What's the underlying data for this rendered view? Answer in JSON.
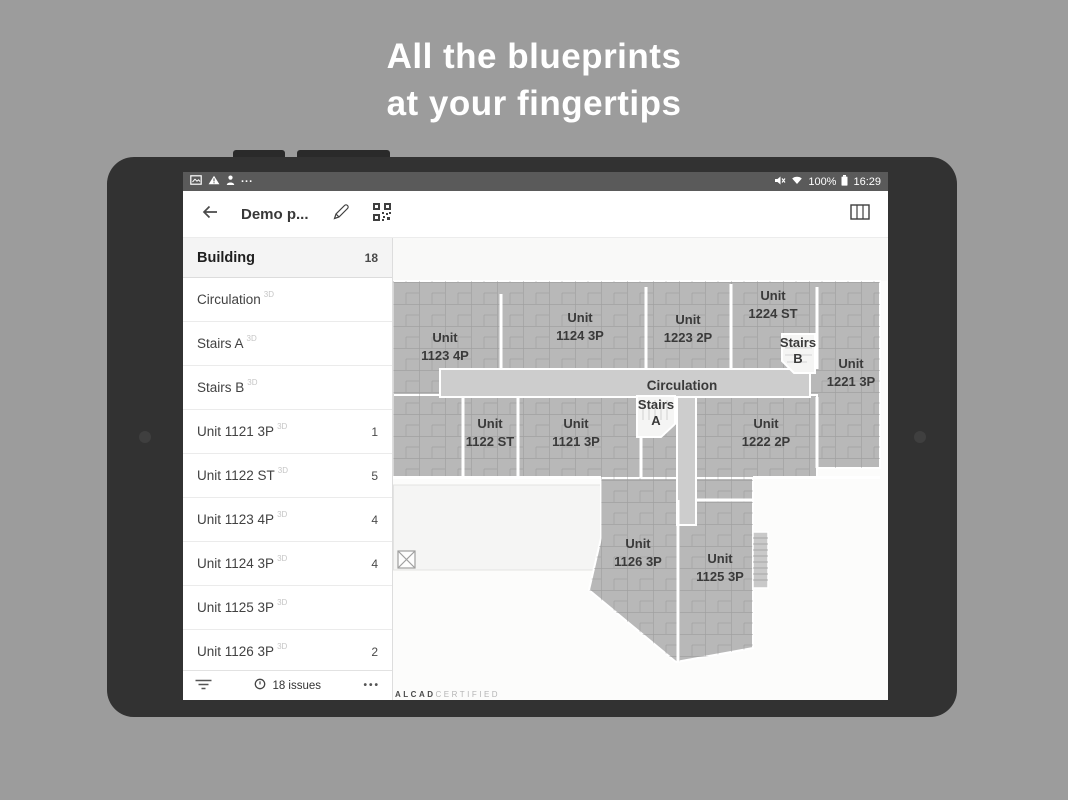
{
  "headline": {
    "line1": "All the blueprints",
    "line2": "at your fingertips"
  },
  "statusbar": {
    "left_icons": [
      "image-icon",
      "warning-icon",
      "person-icon"
    ],
    "menu_dots": "...",
    "right_icons": [
      "mute-icon",
      "wifi-icon",
      "battery-icon"
    ],
    "battery": "100%",
    "time": "16:29"
  },
  "toolbar": {
    "title": "Demo p...",
    "icons": [
      "back-icon",
      "pencil-icon",
      "qr-code-icon",
      "map-book-icon"
    ]
  },
  "sidebar": {
    "header": {
      "label": "Building",
      "count": "18"
    },
    "items": [
      {
        "label": "Circulation",
        "tag": "3D",
        "count": ""
      },
      {
        "label": "Stairs A",
        "tag": "3D",
        "count": ""
      },
      {
        "label": "Stairs B",
        "tag": "3D",
        "count": ""
      },
      {
        "label": "Unit 1121 3P",
        "tag": "3D",
        "count": "1"
      },
      {
        "label": "Unit 1122 ST",
        "tag": "3D",
        "count": "5"
      },
      {
        "label": "Unit 1123 4P",
        "tag": "3D",
        "count": "4"
      },
      {
        "label": "Unit 1124 3P",
        "tag": "3D",
        "count": "4"
      },
      {
        "label": "Unit 1125 3P",
        "tag": "3D",
        "count": ""
      },
      {
        "label": "Unit 1126 3P",
        "tag": "3D",
        "count": "2"
      }
    ],
    "footer": {
      "issues_label": "18 issues",
      "more_label": "•••"
    }
  },
  "plan": {
    "corridor_label": "Circulation",
    "units": [
      {
        "l1": "Unit",
        "l2": "1123 4P"
      },
      {
        "l1": "Unit",
        "l2": "1124 3P"
      },
      {
        "l1": "Unit",
        "l2": "1223 2P"
      },
      {
        "l1": "Unit",
        "l2": "1224 ST"
      },
      {
        "l1": "Unit",
        "l2": "1221 3P"
      },
      {
        "l1": "Unit",
        "l2": "1122 ST"
      },
      {
        "l1": "Unit",
        "l2": "1121 3P"
      },
      {
        "l1": "Unit",
        "l2": "1222 2P"
      },
      {
        "l1": "Unit",
        "l2": "1126 3P"
      },
      {
        "l1": "Unit",
        "l2": "1125 3P"
      },
      {
        "l1": "Stairs",
        "l2": "A"
      },
      {
        "l1": "Stairs",
        "l2": "B"
      }
    ],
    "watermark": {
      "brand": "ALCAD",
      "suffix": "CERTIFIED"
    }
  },
  "colors": {
    "page_bg": "#9c9c9c",
    "tablet_frame": "#323232",
    "statusbar_bg": "#5a5a5a",
    "building_fill": "#b8b8b8",
    "corridor_fill": "#cdcdcd",
    "label_text": "#3a3a3a"
  }
}
